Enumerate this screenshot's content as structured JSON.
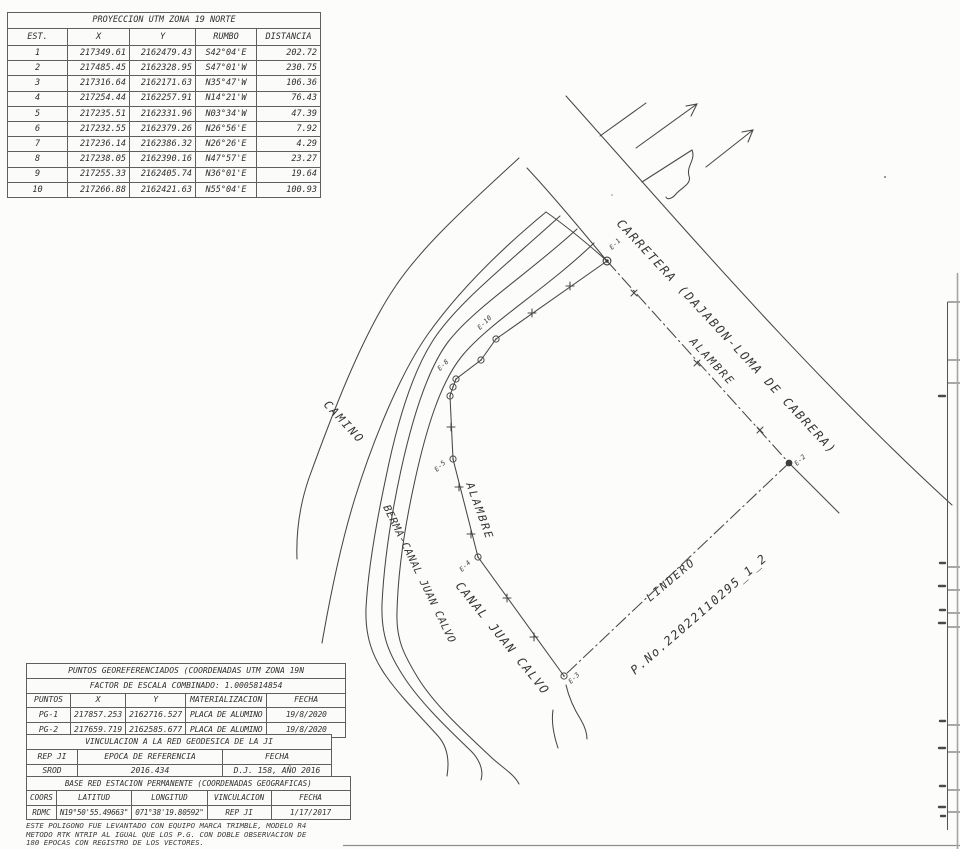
{
  "utm_table": {
    "title": "PROYECCION UTM ZONA 19 NORTE",
    "headers": [
      "EST.",
      "X",
      "Y",
      "RUMBO",
      "DISTANCIA"
    ],
    "rows": [
      [
        "1",
        "217349.61",
        "2162479.43",
        "S42°04'E",
        "202.72"
      ],
      [
        "2",
        "217485.45",
        "2162328.95",
        "S47°01'W",
        "230.75"
      ],
      [
        "3",
        "217316.64",
        "2162171.63",
        "N35°47'W",
        "106.36"
      ],
      [
        "4",
        "217254.44",
        "2162257.91",
        "N14°21'W",
        "76.43"
      ],
      [
        "5",
        "217235.51",
        "2162331.96",
        "N03°34'W",
        "47.39"
      ],
      [
        "6",
        "217232.55",
        "2162379.26",
        "N26°56'E",
        "7.92"
      ],
      [
        "7",
        "217236.14",
        "2162386.32",
        "N26°26'E",
        "4.29"
      ],
      [
        "8",
        "217238.05",
        "2162390.16",
        "N47°57'E",
        "23.27"
      ],
      [
        "9",
        "217255.33",
        "2162405.74",
        "N36°01'E",
        "19.64"
      ],
      [
        "10",
        "217266.88",
        "2162421.63",
        "N55°04'E",
        "100.93"
      ]
    ]
  },
  "geo_block": {
    "title": "PUNTOS GEOREFERENCIADOS (COORDENADAS UTM ZONA 19N",
    "factor_row": "FACTOR DE ESCALA COMBINADO: 1.0005814854",
    "pg_headers": [
      "PUNTOS",
      "X",
      "Y",
      "MATERIALIZACION",
      "FECHA"
    ],
    "pg_rows": [
      [
        "PG-1",
        "217857.253",
        "2162716.527",
        "PLACA DE ALUMINO",
        "19/8/2020"
      ],
      [
        "PG-2",
        "217659.719",
        "2162585.677",
        "PLACA DE ALUMINO",
        "19/8/2020"
      ]
    ],
    "vinc_title": "VINCULACION A LA RED GEODESICA DE LA JI",
    "vinc_headers": [
      "REP JI",
      "EPOCA DE  REFERENCIA",
      "FECHA"
    ],
    "vinc_row": [
      "SROD",
      "2016.434",
      "D.J. 158, AÑO 2016"
    ],
    "base_title": "BASE RED ESTACION PERMANENTE (COORDENADAS GEOGRAFICAS)",
    "base_headers": [
      "COORS",
      "LATITUD",
      "LONGITUD",
      "VINCULACION",
      "FECHA"
    ],
    "base_row": [
      "RDMC",
      "N19°50'55.49663\"",
      "071°38'19.80592\"",
      "REP JI",
      "1/17/2017"
    ]
  },
  "notes": [
    "ESTE POLIGONO FUE LEVANTADO CON EQUIPO MARCA TRIMBLE, MODELO R4",
    "METODO RTK NTRIP AL IGUAL QUE LOS P.G. CON DOBLE OBSERVACION DE",
    "180 EPOCAS CON REGISTRO DE LOS VECTORES."
  ],
  "drawing": {
    "labels": [
      {
        "text": "CARRETERA (DAJABON-LOMA DE CABRERA)",
        "x": 616,
        "y": 224,
        "rot": 47,
        "fs": 12,
        "ls": 1.8
      },
      {
        "text": "ALAMBRE",
        "x": 689,
        "y": 342,
        "rot": 47,
        "fs": 11,
        "ls": 2
      },
      {
        "text": "ALAMBRE",
        "x": 466,
        "y": 484,
        "rot": 70,
        "fs": 11,
        "ls": 2
      },
      {
        "text": "CAMINO",
        "x": 323,
        "y": 405,
        "rot": 47,
        "fs": 11.5,
        "ls": 2
      },
      {
        "text": "BERMA-CANAL JUAN CALVO",
        "x": 383,
        "y": 507,
        "rot": 64,
        "fs": 10.5,
        "ls": 0.6
      },
      {
        "text": "CANAL JUAN CALVO",
        "x": 455,
        "y": 586,
        "rot": 51,
        "fs": 12,
        "ls": 1.6
      },
      {
        "text": "LINDERO",
        "x": 650,
        "y": 602,
        "rot": -40,
        "fs": 11,
        "ls": 2
      },
      {
        "text": "P.No.22022110295_1_2",
        "x": 635,
        "y": 675,
        "rot": -41,
        "fs": 12,
        "ls": 1.6
      }
    ],
    "stations": [
      {
        "id": "E-1",
        "x": 607,
        "y": 261,
        "kind": "bull",
        "lx": 612,
        "ly": 250
      },
      {
        "id": "E-2",
        "x": 789,
        "y": 463,
        "kind": "dot",
        "lx": 797,
        "ly": 466
      },
      {
        "id": "E-3",
        "x": 564,
        "y": 676,
        "kind": "ring",
        "lx": 571,
        "ly": 684
      },
      {
        "id": "E-4",
        "x": 478,
        "y": 557,
        "kind": "ring",
        "lx": 462,
        "ly": 572
      },
      {
        "id": "E-5",
        "x": 453,
        "y": 459,
        "kind": "ring",
        "lx": 437,
        "ly": 472
      },
      {
        "id": "E-6",
        "x": 450,
        "y": 396,
        "kind": "ring"
      },
      {
        "id": "E-7",
        "x": 453,
        "y": 387,
        "kind": "ring"
      },
      {
        "id": "E-8",
        "x": 456,
        "y": 379,
        "kind": "ring",
        "lx": 440,
        "ly": 371
      },
      {
        "id": "E-9",
        "x": 481,
        "y": 360,
        "kind": "ring"
      },
      {
        "id": "E-10",
        "x": 496,
        "y": 339,
        "kind": "ring",
        "lx": 480,
        "ly": 330
      }
    ],
    "plus_ticks": [
      [
        534,
        637
      ],
      [
        507,
        598
      ],
      [
        471,
        534
      ],
      [
        459,
        487
      ],
      [
        451,
        427
      ],
      [
        532,
        313
      ],
      [
        570,
        286
      ]
    ],
    "x_ticks": [
      [
        634,
        293
      ],
      [
        697,
        363
      ],
      [
        760,
        430
      ]
    ]
  }
}
